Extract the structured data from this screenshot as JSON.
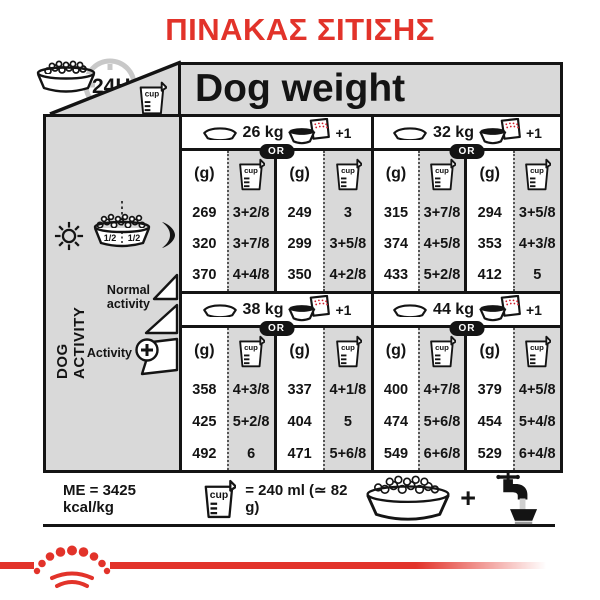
{
  "title": "ΠΙΝΑΚΑΣ ΣΙΤΙΣΗΣ",
  "colors": {
    "brand_red": "#e2332a",
    "panel_gray": "#d9d9d9",
    "ink": "#141414"
  },
  "header": {
    "daily_label": "24H",
    "dog_weight_label": "Dog weight",
    "cup_label": "cup"
  },
  "sidebar": {
    "axis_label": "DOG ACTIVITY",
    "half_left": "1/2",
    "half_right": "1/2",
    "normal_activity_label": "Normal activity",
    "activity_plus_label": "Activity"
  },
  "labels": {
    "unit_g": "(g)",
    "cup": "cup",
    "or": "OR",
    "plus_one": "+1"
  },
  "quadrants": [
    {
      "weight": "26 kg",
      "dry": {
        "g": [
          "269",
          "320",
          "370"
        ],
        "cups": [
          "3+2/8",
          "3+7/8",
          "4+4/8"
        ]
      },
      "mix": {
        "g": [
          "249",
          "299",
          "350"
        ],
        "cups": [
          "3",
          "3+5/8",
          "4+2/8"
        ]
      }
    },
    {
      "weight": "32 kg",
      "dry": {
        "g": [
          "315",
          "374",
          "433"
        ],
        "cups": [
          "3+7/8",
          "4+5/8",
          "5+2/8"
        ]
      },
      "mix": {
        "g": [
          "294",
          "353",
          "412"
        ],
        "cups": [
          "3+5/8",
          "4+3/8",
          "5"
        ]
      }
    },
    {
      "weight": "38 kg",
      "dry": {
        "g": [
          "358",
          "425",
          "492"
        ],
        "cups": [
          "4+3/8",
          "5+2/8",
          "6"
        ]
      },
      "mix": {
        "g": [
          "337",
          "404",
          "471"
        ],
        "cups": [
          "4+1/8",
          "5",
          "5+6/8"
        ]
      }
    },
    {
      "weight": "44 kg",
      "dry": {
        "g": [
          "400",
          "474",
          "549"
        ],
        "cups": [
          "4+7/8",
          "5+6/8",
          "6+6/8"
        ]
      },
      "mix": {
        "g": [
          "379",
          "454",
          "529"
        ],
        "cups": [
          "4+5/8",
          "5+4/8",
          "6+4/8"
        ]
      }
    }
  ],
  "footer": {
    "me_label": "ME = 3425 kcal/kg",
    "cup_label": "cup",
    "cup_equiv": "= 240 ml (≃ 82 g)",
    "plus_symbol": "+"
  }
}
